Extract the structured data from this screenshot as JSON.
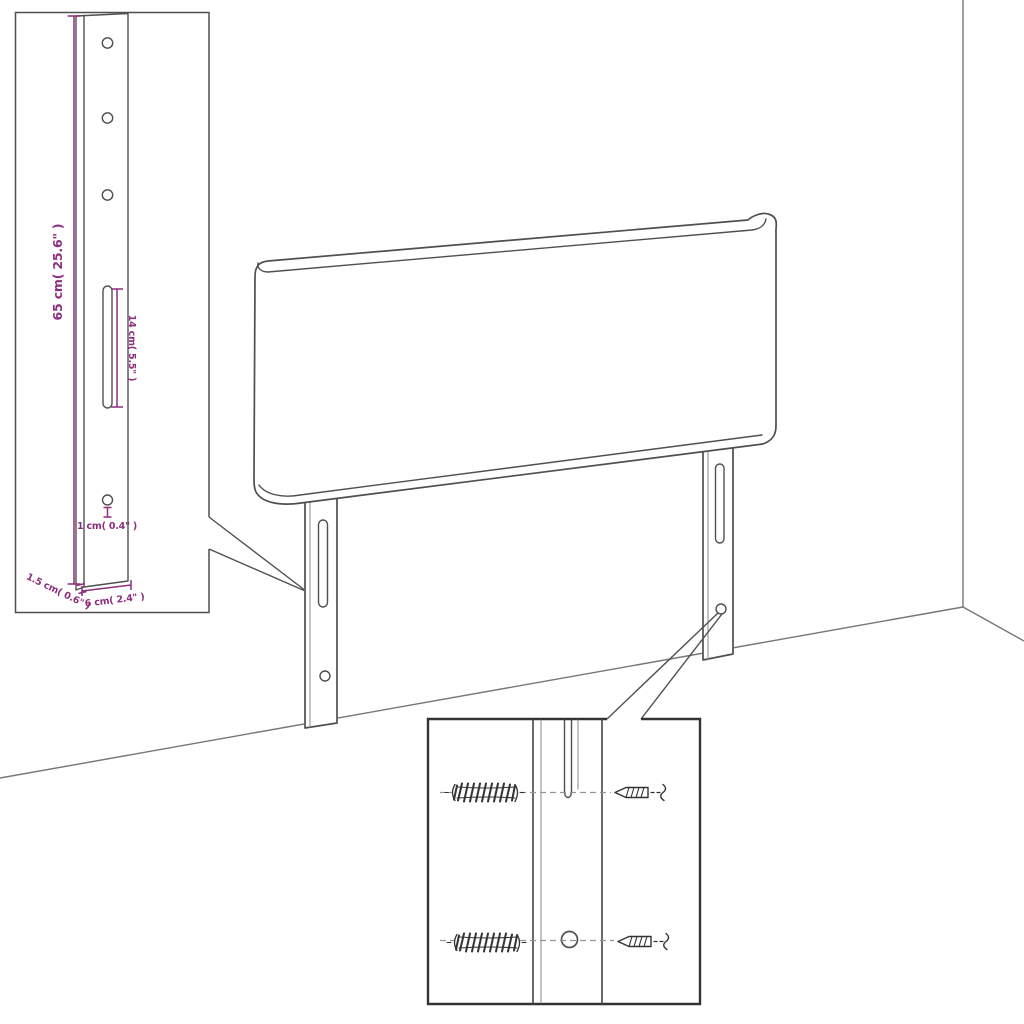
{
  "diagram": {
    "type": "product-dimension-line-drawing",
    "subject": "headboard with two wall-mount legs, detail insets for leg bracket and wall fixing hardware"
  },
  "colors": {
    "background": "#ffffff",
    "line": "#4f4f4f",
    "line_light": "#949494",
    "wall": "#767676",
    "hardware": "#333333",
    "dimension": "#8e2e7e"
  },
  "bracket_inset": {
    "dim_height": "65 cm( 25.6\" )",
    "dim_slot": "14 cm( 5.5\" )",
    "dim_hole": "1 cm( 0.4\" )",
    "dim_thickness": "1.5 cm( 0.6\" )",
    "dim_width": "6 cm( 2.4\" )"
  }
}
